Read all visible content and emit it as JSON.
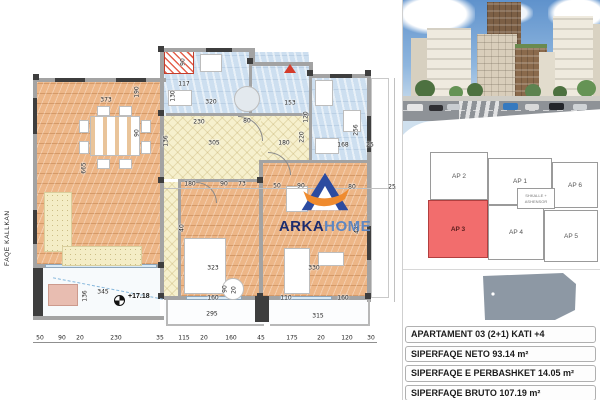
{
  "floor_plan": {
    "side_label": "FAQE KALLKAN",
    "level_marker": "+17.18",
    "logo": {
      "name_primary": "ARKA",
      "name_secondary": "HOME"
    },
    "dim_labels": [
      {
        "t": "373",
        "x": 106,
        "y": 100
      },
      {
        "t": "90",
        "x": 183,
        "y": 62,
        "v": 1
      },
      {
        "t": "117",
        "x": 184,
        "y": 84
      },
      {
        "t": "130",
        "x": 173,
        "y": 96,
        "v": 1
      },
      {
        "t": "320",
        "x": 211,
        "y": 102
      },
      {
        "t": "153",
        "x": 290,
        "y": 103
      },
      {
        "t": "120",
        "x": 306,
        "y": 117,
        "v": 1
      },
      {
        "t": "220",
        "x": 302,
        "y": 137,
        "v": 1
      },
      {
        "t": "256",
        "x": 356,
        "y": 130,
        "v": 1
      },
      {
        "t": "230",
        "x": 199,
        "y": 122
      },
      {
        "t": "80",
        "x": 247,
        "y": 121
      },
      {
        "t": "136",
        "x": 166,
        "y": 141,
        "v": 1
      },
      {
        "t": "305",
        "x": 214,
        "y": 143
      },
      {
        "t": "180",
        "x": 284,
        "y": 143
      },
      {
        "t": "168",
        "x": 343,
        "y": 145
      },
      {
        "t": "25",
        "x": 370,
        "y": 145
      },
      {
        "t": "190",
        "x": 137,
        "y": 92,
        "v": 1
      },
      {
        "t": "90",
        "x": 137,
        "y": 133,
        "v": 1
      },
      {
        "t": "665",
        "x": 84,
        "y": 168,
        "v": 1
      },
      {
        "t": "180",
        "x": 190,
        "y": 184
      },
      {
        "t": "90",
        "x": 224,
        "y": 184
      },
      {
        "t": "73",
        "x": 242,
        "y": 184
      },
      {
        "t": "50",
        "x": 277,
        "y": 186
      },
      {
        "t": "90",
        "x": 301,
        "y": 186
      },
      {
        "t": "80",
        "x": 327,
        "y": 186
      },
      {
        "t": "80",
        "x": 352,
        "y": 187
      },
      {
        "t": "25",
        "x": 392,
        "y": 187
      },
      {
        "t": "40",
        "x": 182,
        "y": 228,
        "v": 1
      },
      {
        "t": "445",
        "x": 357,
        "y": 228,
        "v": 1
      },
      {
        "t": "323",
        "x": 213,
        "y": 268
      },
      {
        "t": "330",
        "x": 314,
        "y": 268
      },
      {
        "t": "345",
        "x": 103,
        "y": 292
      },
      {
        "t": "136",
        "x": 85,
        "y": 296,
        "v": 1
      },
      {
        "t": "160",
        "x": 213,
        "y": 298
      },
      {
        "t": "110",
        "x": 286,
        "y": 298
      },
      {
        "t": "160",
        "x": 343,
        "y": 298
      },
      {
        "t": "90",
        "x": 225,
        "y": 289,
        "v": 1
      },
      {
        "t": "20",
        "x": 234,
        "y": 290,
        "v": 1
      },
      {
        "t": "295",
        "x": 212,
        "y": 314
      },
      {
        "t": "315",
        "x": 318,
        "y": 316
      },
      {
        "t": "50",
        "x": 40,
        "y": 338
      },
      {
        "t": "90",
        "x": 62,
        "y": 338
      },
      {
        "t": "20",
        "x": 80,
        "y": 338
      },
      {
        "t": "230",
        "x": 116,
        "y": 338
      },
      {
        "t": "35",
        "x": 160,
        "y": 338
      },
      {
        "t": "115",
        "x": 184,
        "y": 338
      },
      {
        "t": "20",
        "x": 204,
        "y": 338
      },
      {
        "t": "160",
        "x": 231,
        "y": 338
      },
      {
        "t": "45",
        "x": 261,
        "y": 338
      },
      {
        "t": "175",
        "x": 292,
        "y": 338
      },
      {
        "t": "20",
        "x": 321,
        "y": 338
      },
      {
        "t": "120",
        "x": 347,
        "y": 338
      },
      {
        "t": "30",
        "x": 371,
        "y": 338
      }
    ]
  },
  "key_plan": {
    "core_label_line1": "SHKALLE +",
    "core_label_line2": "ASHENSOR",
    "highlight_color": "#f26d6d",
    "units": [
      {
        "id": "ap2",
        "label": "AP 2",
        "x": 5,
        "y": 4,
        "w": 58,
        "h": 48,
        "highlight": false
      },
      {
        "id": "ap1",
        "label": "AP 1",
        "x": 63,
        "y": 10,
        "w": 64,
        "h": 47,
        "highlight": false
      },
      {
        "id": "ap6",
        "label": "AP 6",
        "x": 127,
        "y": 14,
        "w": 46,
        "h": 46,
        "highlight": false
      },
      {
        "id": "ap3",
        "label": "AP 3",
        "x": 3,
        "y": 52,
        "w": 60,
        "h": 58,
        "highlight": true
      },
      {
        "id": "ap4",
        "label": "AP 4",
        "x": 63,
        "y": 57,
        "w": 56,
        "h": 55,
        "highlight": false
      },
      {
        "id": "ap5",
        "label": "AP 5",
        "x": 119,
        "y": 62,
        "w": 54,
        "h": 52,
        "highlight": false
      }
    ]
  },
  "info_panel": {
    "rows": [
      "APARTAMENT 03  (2+1) KATI +4",
      "SIPERFAQE NETO  93.14 m²",
      "SIPERFAQE E PERBASHKET 14.05 m²",
      "SIPERFAQE BRUTO 107.19 m²"
    ]
  }
}
